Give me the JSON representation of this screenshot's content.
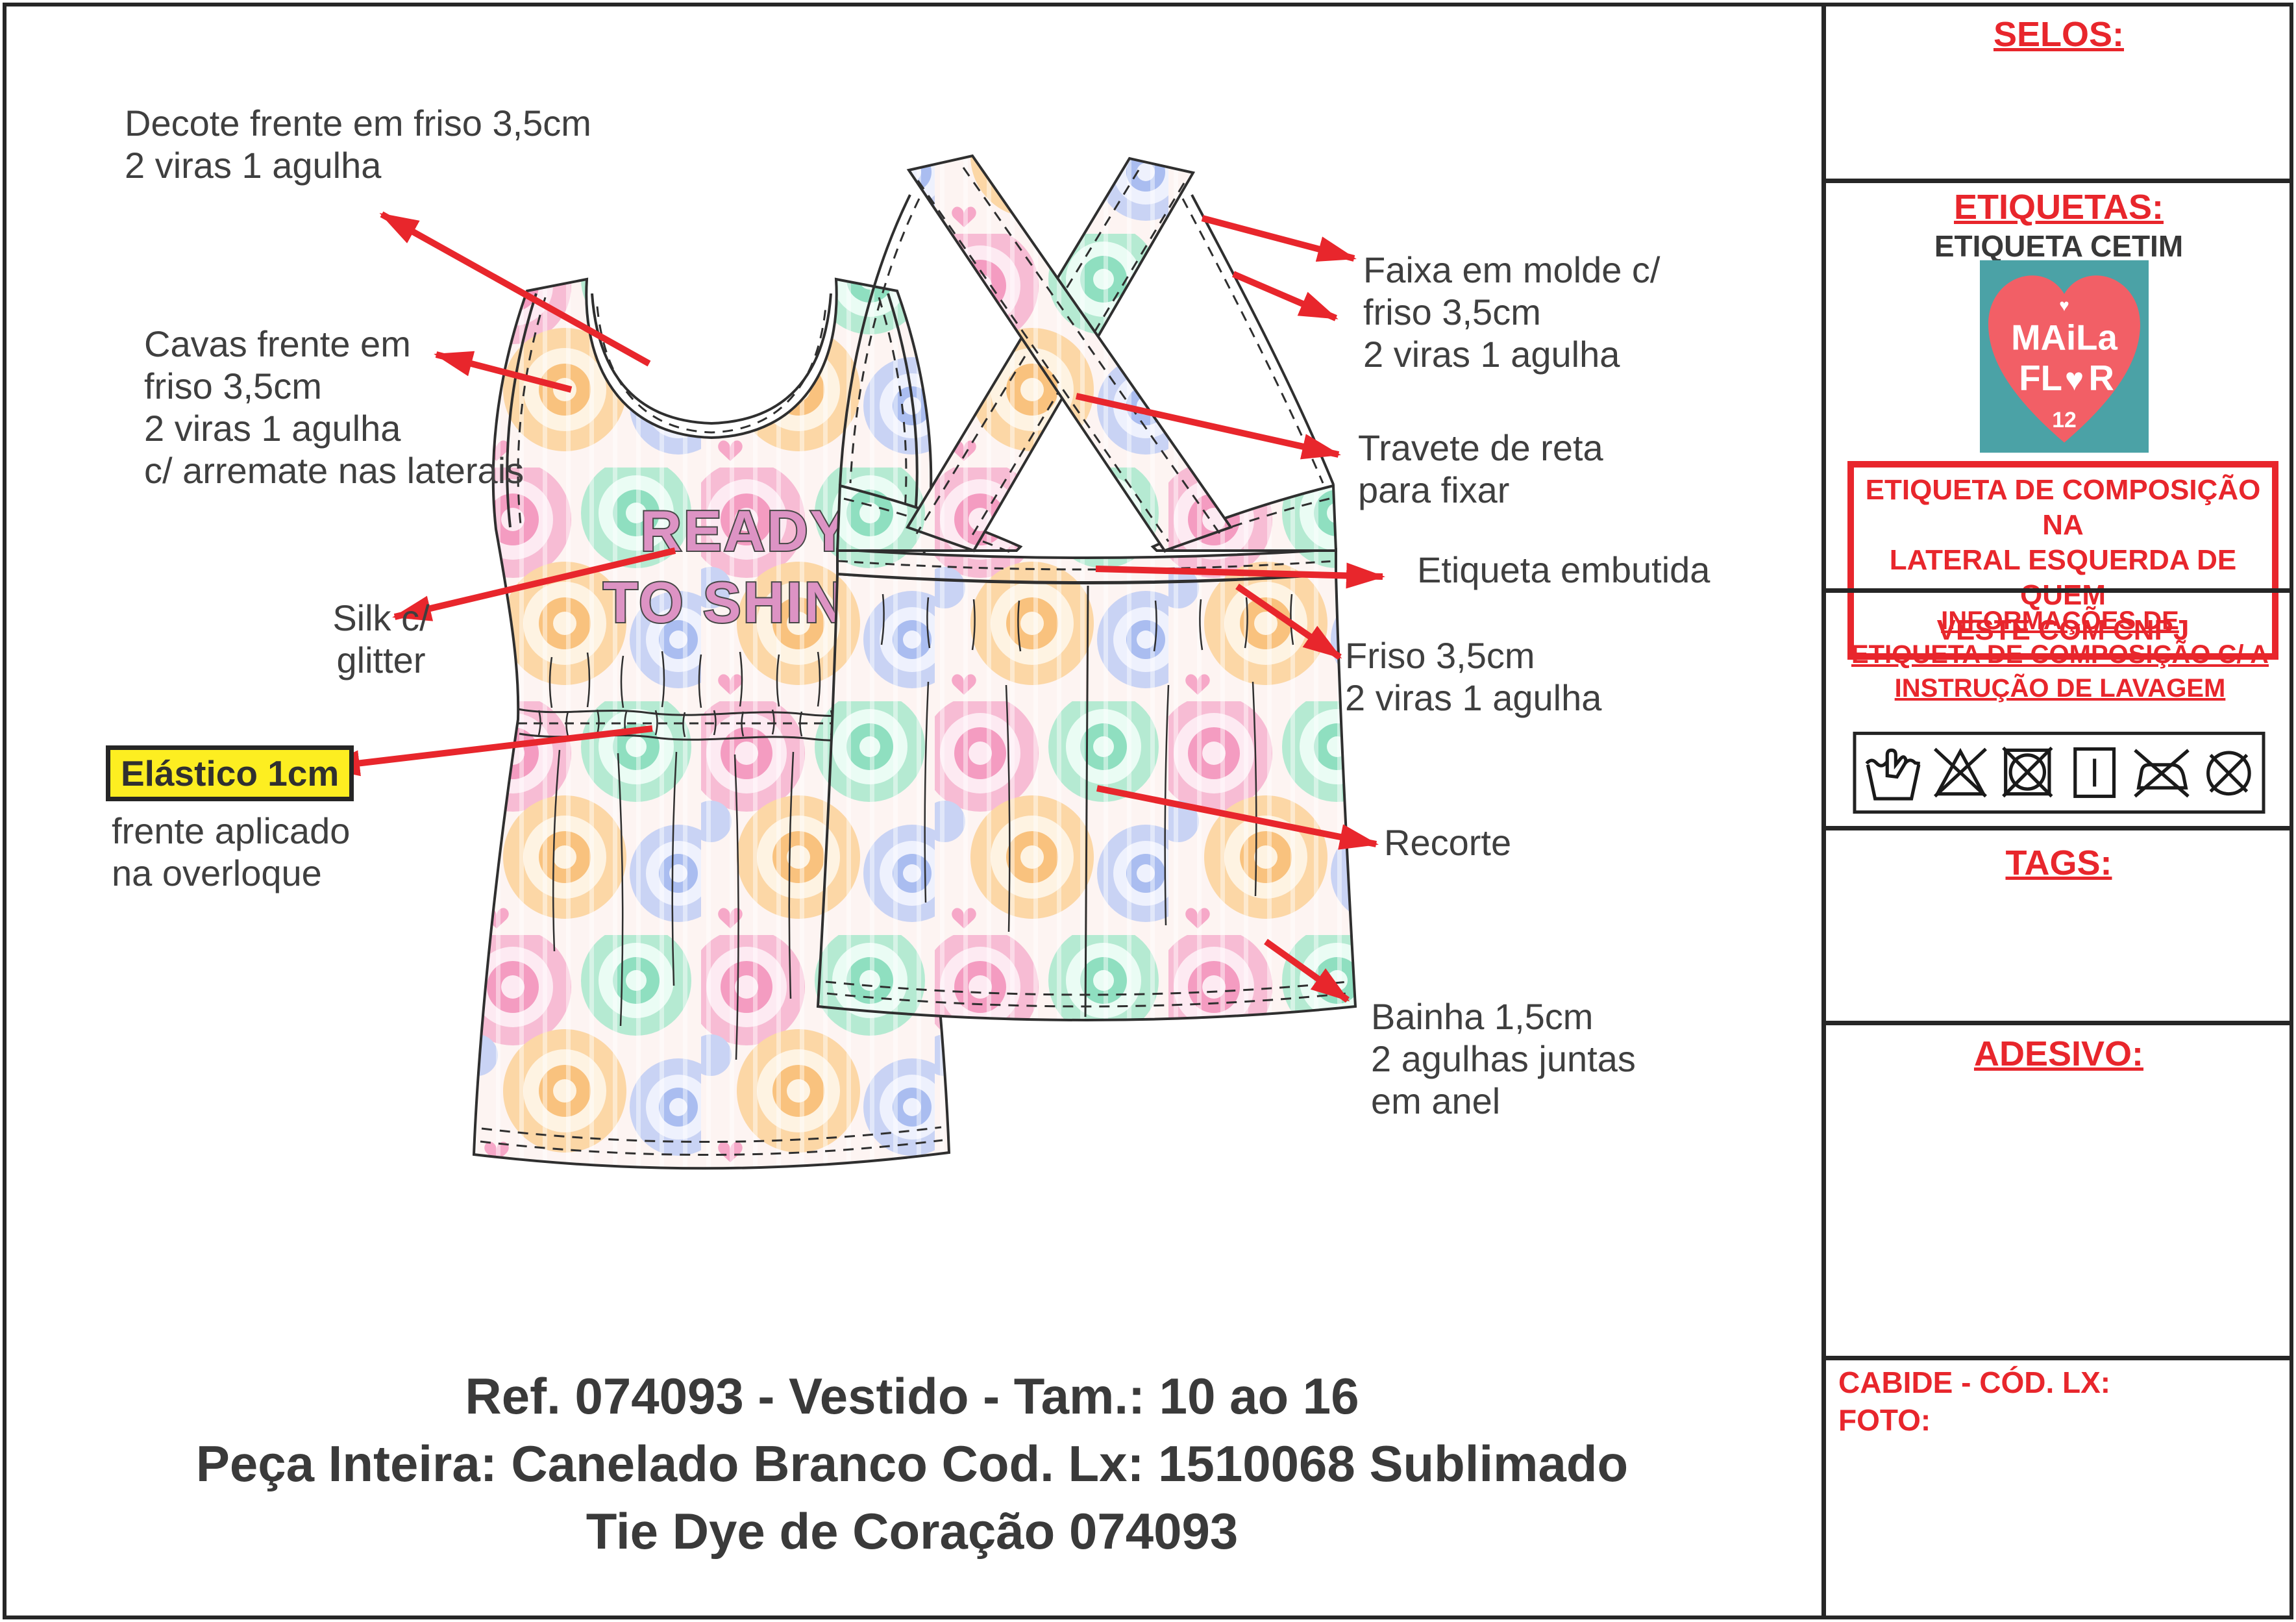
{
  "annotations": {
    "decote": "Decote frente em friso 3,5cm\n2 viras 1 agulha",
    "cavas": "Cavas frente em\nfriso 3,5cm\n2 viras 1 agulha\nc/ arremate nas laterais",
    "silk": "Silk c/\nglitter",
    "elastico_title": "Elástico 1cm",
    "elastico_sub": "frente aplicado\nna overloque",
    "faixa": "Faixa em molde c/\nfriso 3,5cm\n2 viras 1 agulha",
    "travete": "Travete de reta\npara fixar",
    "etiqueta_embutida": "Etiqueta embutida",
    "friso": "Friso 3,5cm\n2 viras 1 agulha",
    "recorte": "Recorte",
    "bainha": "Bainha 1,5cm\n2 agulhas juntas\nem anel"
  },
  "garment_print": {
    "line1": "READY",
    "line2": "TO SHINE"
  },
  "footer": {
    "line1": "Ref. 074093 - Vestido - Tam.: 10 ao 16",
    "line2": "Peça Inteira: Canelado Branco Cod. Lx: 1510068 Sublimado",
    "line3": "Tie Dye de Coração 074093"
  },
  "sidebar": {
    "selos_label": "SELOS:",
    "etiquetas_label": "ETIQUETAS:",
    "etiqueta_cetim_label": "ETIQUETA CETIM",
    "logo": {
      "top_heart": "♥",
      "word1": "MAiLa",
      "word2_prefix": "FL",
      "word2_heart": "♥",
      "word2_suffix": "R",
      "size_number": "12"
    },
    "composicao_box": "ETIQUETA DE COMPOSIÇÃO NA\nLATERAL ESQUERDA DE QUEM\nVESTE COM CNPJ",
    "informacoes": "INFORMAÇÕES DE\nETIQUETA DE COMPOSIÇÃO C/ A\nINSTRUÇÃO DE LAVAGEM",
    "tags_label": "TAGS:",
    "adesivo_label": "ADESIVO:",
    "cabide_label": "CABIDE - CÓD. LX:",
    "foto_label": "FOTO:",
    "care_symbols": [
      "hand-wash",
      "do-not-bleach",
      "do-not-tumble-dry",
      "line-dry",
      "do-not-iron",
      "do-not-dry-clean"
    ]
  },
  "colors": {
    "accent_red": "#e8262c",
    "annotation_gray": "#3f3f3f",
    "highlight_yellow": "#fdee21",
    "print_pink": "#dd93c4",
    "logo_teal": "#4ba2a6",
    "logo_coral": "#f25f66"
  }
}
